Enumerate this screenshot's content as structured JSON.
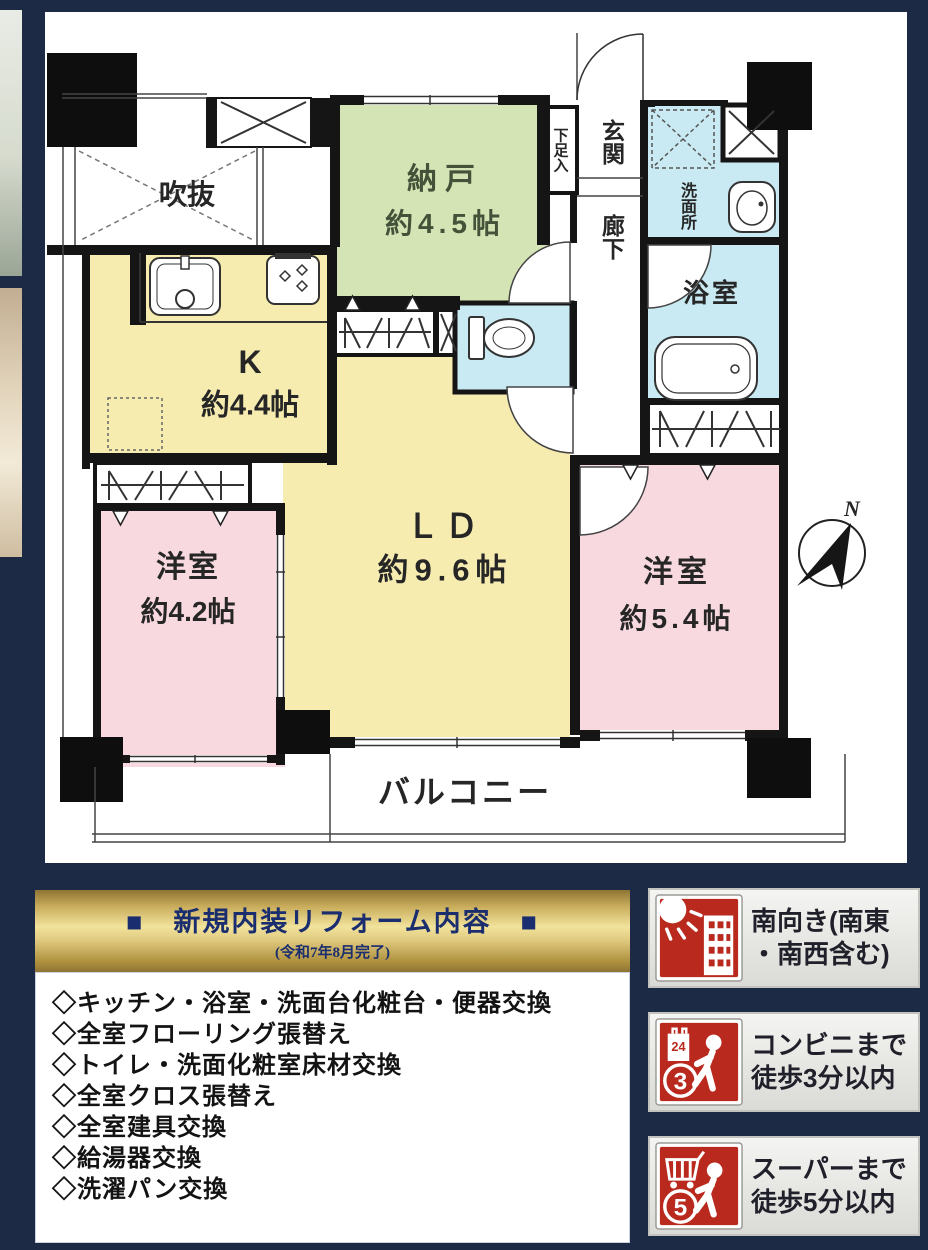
{
  "page": {
    "background": "#1c2a45"
  },
  "floorplan": {
    "rooms": {
      "void": "吹抜",
      "storage_name": "納戸",
      "storage_size": "約4.5帖",
      "kitchen_name": "K",
      "kitchen_size": "約4.4帖",
      "shoe_box": "下足入",
      "entrance": "玄関",
      "hallway": "廊下",
      "washroom": "洗面所",
      "bathroom": "浴室",
      "living_name": "ＬＤ",
      "living_size": "約9.6帖",
      "west_room_a_name": "洋室",
      "west_room_a_size": "約4.2帖",
      "west_room_b_name": "洋室",
      "west_room_b_size": "約5.4帖",
      "balcony": "バルコニー",
      "compass_north": "N"
    },
    "colors": {
      "tatami_yellow": "#f6ecb0",
      "storage_green": "#d5e4b5",
      "bedroom_pink": "#f8d9df",
      "wet_area_blue": "#c9eaf2",
      "wall_black": "#151515"
    }
  },
  "renovation": {
    "title": "■　新規内装リフォーム内容　■",
    "subtitle": "(令和7年8月完了)",
    "title_color": "#1a2d6e",
    "items": [
      "◇キッチン・浴室・洗面台化粧台・便器交換",
      "◇全室フローリング張替え",
      "◇トイレ・洗面化粧室床材交換",
      "◇全室クロス張替え",
      "◇全室建具交換",
      "◇給湯器交換",
      "◇洗濯パン交換"
    ]
  },
  "badges": [
    {
      "icon": "sun-building",
      "line1": "南向き(南東",
      "line2": "・南西含む)"
    },
    {
      "icon": "convenience-store",
      "bag_label": "24",
      "number": "3",
      "line1": "コンビニまで",
      "line2": "徒歩3分以内"
    },
    {
      "icon": "supermarket",
      "number": "5",
      "line1": "スーパーまで",
      "line2": "徒歩5分以内"
    }
  ],
  "badge_red": "#b9291e"
}
